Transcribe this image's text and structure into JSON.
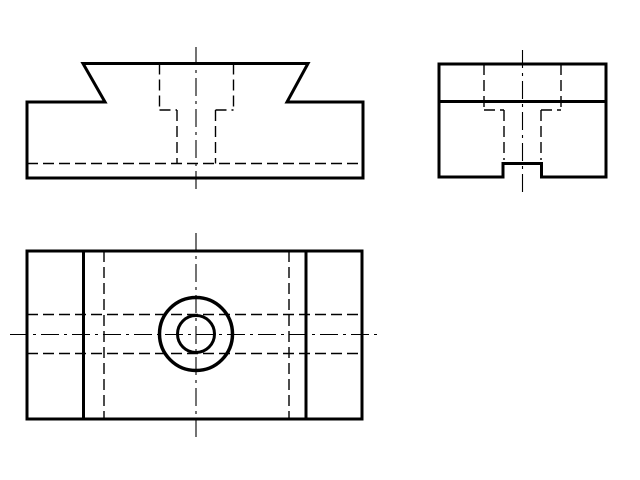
{
  "page": {
    "width": 640,
    "height": 480,
    "background": "#ffffff"
  },
  "drawing": {
    "name": "three-view-orthographic-projection",
    "stroke_color": "#000000",
    "line_styles": {
      "visible": {
        "width": 3.0,
        "dash": null
      },
      "visible_heavy": {
        "width": 3.5,
        "dash": null
      },
      "hidden": {
        "width": 1.4,
        "dash": "11,5"
      },
      "center": {
        "width": 1.1,
        "dash": "18,5,3,5"
      }
    },
    "views": [
      {
        "name": "front-view",
        "polygons": [
          {
            "name": "front-outline",
            "style": "visible",
            "points": "27,102 105,102 83,63.5 308,63.5 287,102 363,102 363,178 27,178"
          }
        ],
        "lines": [
          {
            "name": "counterbore-left-hidden-edge",
            "style": "hidden",
            "x1": 159.5,
            "y1": 63.5,
            "x2": 159.5,
            "y2": 110
          },
          {
            "name": "counterbore-right-hidden-edge",
            "style": "hidden",
            "x1": 233.5,
            "y1": 63.5,
            "x2": 233.5,
            "y2": 110
          },
          {
            "name": "counterbore-shoulder-left",
            "style": "hidden",
            "x1": 159.5,
            "y1": 110,
            "x2": 177,
            "y2": 110
          },
          {
            "name": "counterbore-shoulder-right",
            "style": "hidden",
            "x1": 215.5,
            "y1": 110,
            "x2": 233.5,
            "y2": 110
          },
          {
            "name": "hole-left-hidden-edge",
            "style": "hidden",
            "x1": 177,
            "y1": 110,
            "x2": 177,
            "y2": 163.5
          },
          {
            "name": "hole-right-hidden-edge",
            "style": "hidden",
            "x1": 215.5,
            "y1": 110,
            "x2": 215.5,
            "y2": 163.5
          },
          {
            "name": "groove-bottom-hidden-edge",
            "style": "hidden",
            "x1": 27,
            "y1": 163.5,
            "x2": 363,
            "y2": 163.5
          },
          {
            "name": "vertical-center-line",
            "style": "center",
            "x1": 196,
            "y1": 47,
            "x2": 196,
            "y2": 191
          }
        ],
        "circles": []
      },
      {
        "name": "side-view",
        "polygons": [
          {
            "name": "side-outline-with-notch",
            "style": "visible",
            "points": "439,64 606,64 606,177 541.5,177 541.5,163.5 503,163.5 503,177 439,177"
          }
        ],
        "lines": [
          {
            "name": "boss-base-visible-edge",
            "style": "visible",
            "x1": 439,
            "y1": 101.5,
            "x2": 606,
            "y2": 101.5
          },
          {
            "name": "counterbore-left-hidden-edge",
            "style": "hidden",
            "x1": 484,
            "y1": 64,
            "x2": 484,
            "y2": 110
          },
          {
            "name": "counterbore-right-hidden-edge",
            "style": "hidden",
            "x1": 561,
            "y1": 64,
            "x2": 561,
            "y2": 110
          },
          {
            "name": "counterbore-shoulder-left",
            "style": "hidden",
            "x1": 484,
            "y1": 110,
            "x2": 504,
            "y2": 110
          },
          {
            "name": "counterbore-shoulder-right",
            "style": "hidden",
            "x1": 541,
            "y1": 110,
            "x2": 561,
            "y2": 110
          },
          {
            "name": "hole-left-hidden-edge",
            "style": "hidden",
            "x1": 504,
            "y1": 110,
            "x2": 504,
            "y2": 160
          },
          {
            "name": "hole-right-hidden-edge",
            "style": "hidden",
            "x1": 541,
            "y1": 110,
            "x2": 541,
            "y2": 160
          },
          {
            "name": "vertical-center-line",
            "style": "center",
            "x1": 522.5,
            "y1": 50,
            "x2": 522.5,
            "y2": 197
          }
        ],
        "circles": []
      },
      {
        "name": "top-view",
        "polygons": [
          {
            "name": "top-outline",
            "style": "visible",
            "points": "27,251 362,251 362,419 27,419"
          }
        ],
        "lines": [
          {
            "name": "dovetail-left-visible-edge",
            "style": "visible",
            "x1": 83.5,
            "y1": 251,
            "x2": 83.5,
            "y2": 419
          },
          {
            "name": "dovetail-right-visible-edge",
            "style": "visible",
            "x1": 306,
            "y1": 251,
            "x2": 306,
            "y2": 419
          },
          {
            "name": "dovetail-left-hidden-edge",
            "style": "hidden",
            "x1": 104,
            "y1": 251,
            "x2": 104,
            "y2": 419
          },
          {
            "name": "dovetail-right-hidden-edge",
            "style": "hidden",
            "x1": 289,
            "y1": 251,
            "x2": 289,
            "y2": 419
          },
          {
            "name": "groove-upper-hidden-edge",
            "style": "hidden",
            "x1": 27,
            "y1": 314.5,
            "x2": 362,
            "y2": 314.5
          },
          {
            "name": "groove-lower-hidden-edge",
            "style": "hidden",
            "x1": 27,
            "y1": 353.5,
            "x2": 362,
            "y2": 353.5
          },
          {
            "name": "vertical-center-line",
            "style": "center",
            "x1": 196,
            "y1": 233,
            "x2": 196,
            "y2": 439
          },
          {
            "name": "horizontal-center-line",
            "style": "center",
            "x1": 10,
            "y1": 334.5,
            "x2": 382,
            "y2": 334.5
          }
        ],
        "circles": [
          {
            "name": "counterbore-circle",
            "style": "visible_heavy",
            "cx": 196,
            "cy": 334,
            "r": 36.5
          },
          {
            "name": "hole-circle",
            "style": "visible",
            "cx": 196,
            "cy": 334,
            "r": 18.5
          }
        ]
      }
    ]
  }
}
